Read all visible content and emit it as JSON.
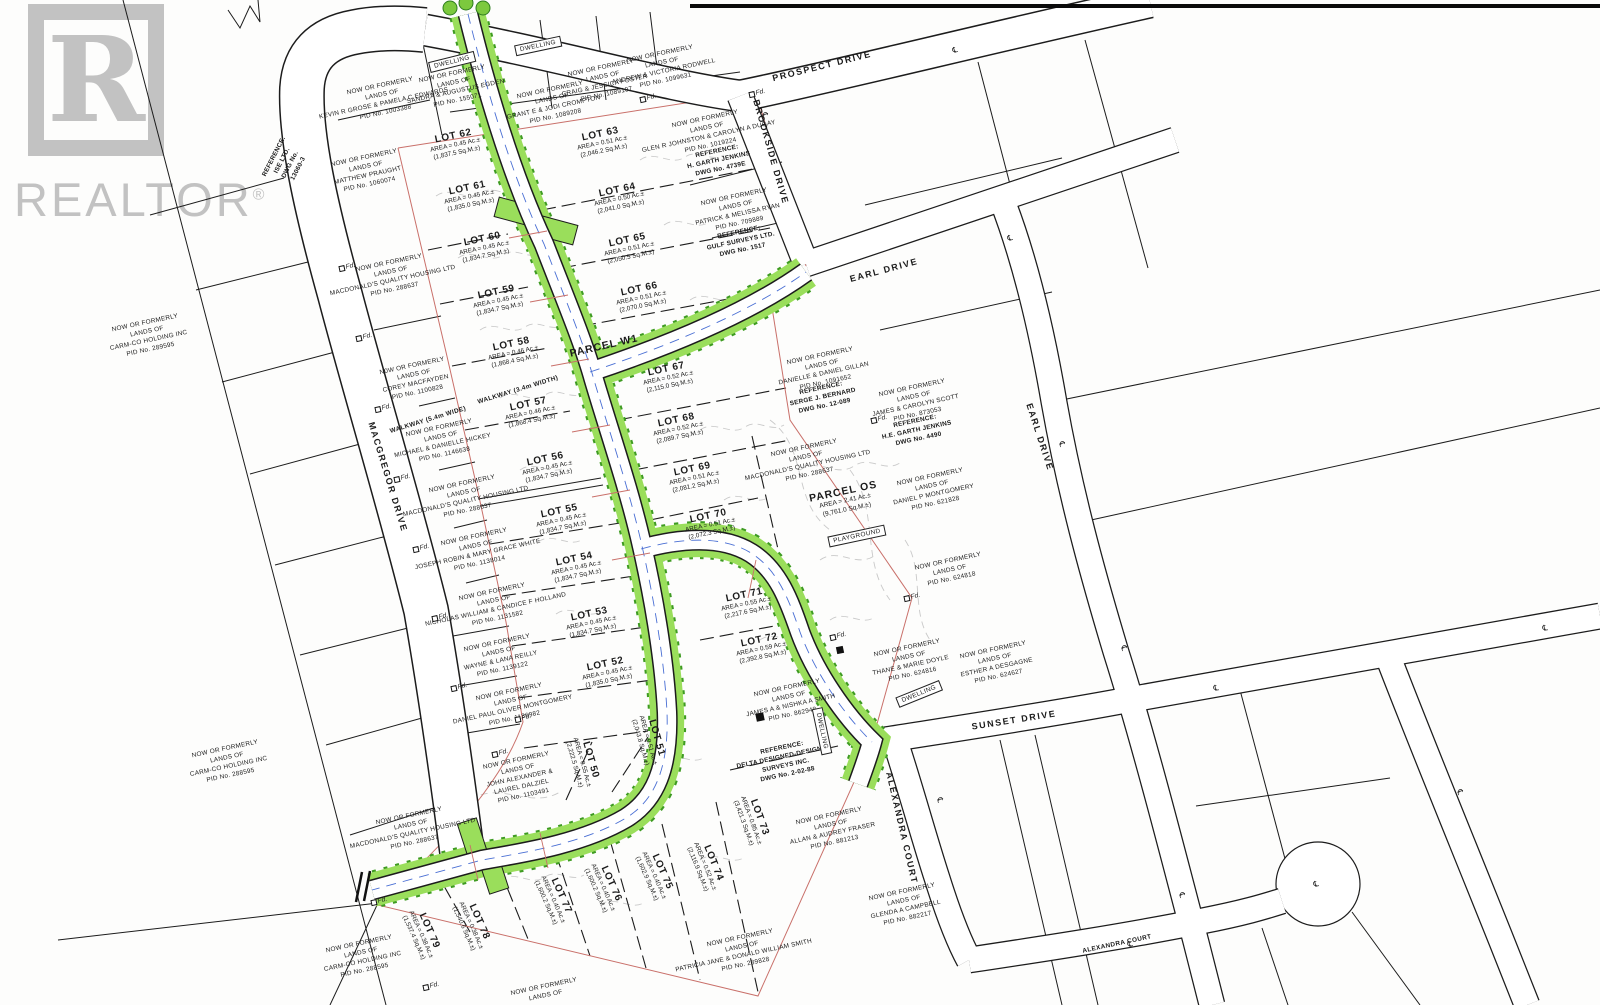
{
  "colors": {
    "watermark": "#c2c2c2",
    "line": "#1c1c1c",
    "contour": "#c9c9c9",
    "road-green": "#9ade5b",
    "green-dark": "#3e9b22",
    "boundary-red": "#c9706a",
    "centerline-blue": "#4a6fd4"
  },
  "watermark": {
    "logo_letter": "R",
    "brand": "REALTOR",
    "reg": "®"
  },
  "streets": [
    {
      "label": "PROSPECT DRIVE",
      "x": 822,
      "y": 66,
      "rot": -14
    },
    {
      "label": "BROOKSIDE DRIVE",
      "x": 771,
      "y": 152,
      "rot": 74
    },
    {
      "label": "EARL DRIVE",
      "x": 884,
      "y": 270,
      "rot": -15
    },
    {
      "label": "EARL DRIVE",
      "x": 1040,
      "y": 437,
      "rot": 72
    },
    {
      "label": "MACGREGOR DRIVE",
      "x": 388,
      "y": 477,
      "rot": 73
    },
    {
      "label": "SUNSET DRIVE",
      "x": 1014,
      "y": 720,
      "rot": -9
    },
    {
      "label": "ALEXANDRA COURT",
      "x": 902,
      "y": 828,
      "rot": 77
    },
    {
      "label": "ALEXANDRA COURT",
      "x": 1117,
      "y": 944,
      "rot": -12,
      "small": true
    },
    {
      "label": "WALKWAY (3.4m WIDTH)",
      "x": 518,
      "y": 390,
      "rot": -17,
      "small": true
    },
    {
      "label": "WALKWAY (5.4m WIDE)",
      "x": 428,
      "y": 420,
      "rot": -17,
      "small": true,
      "bold": true
    }
  ],
  "lots": [
    {
      "name": "LOT 50",
      "area": "AREA = 0.55 Ac.±",
      "sqm": "(2,222.5 Sq.M.±)",
      "x": 583,
      "y": 762,
      "rot": 74
    },
    {
      "name": "LOT 51",
      "area": "AREA = 0.51 Ac.±",
      "sqm": "(2,043.8 Sq.M.±)",
      "x": 649,
      "y": 740,
      "rot": 74
    },
    {
      "name": "LOT 52",
      "area": "AREA = 0.45 Ac.±",
      "sqm": "(1,835.0 Sq.M.±)",
      "x": 607,
      "y": 672,
      "rot": -12
    },
    {
      "name": "LOT 53",
      "area": "AREA = 0.45 Ac.±",
      "sqm": "(1,834.7 Sq.M.±)",
      "x": 591,
      "y": 622,
      "rot": -12
    },
    {
      "name": "LOT 54",
      "area": "AREA = 0.45 Ac.±",
      "sqm": "(1,834.7 Sq.M.±)",
      "x": 576,
      "y": 567,
      "rot": -12
    },
    {
      "name": "LOT 55",
      "area": "AREA = 0.45 Ac.±",
      "sqm": "(1,834.7 Sq.M.±)",
      "x": 561,
      "y": 519,
      "rot": -12
    },
    {
      "name": "LOT 56",
      "area": "AREA = 0.45 Ac.±",
      "sqm": "(1,834.7 Sq.M.±)",
      "x": 547,
      "y": 467,
      "rot": -12
    },
    {
      "name": "LOT 57",
      "area": "AREA = 0.46 Ac.±",
      "sqm": "(1,868.4 Sq.M.±)",
      "x": 530,
      "y": 412,
      "rot": -12
    },
    {
      "name": "LOT 58",
      "area": "AREA = 0.46 Ac.±",
      "sqm": "(1,868.4 Sq.M.±)",
      "x": 513,
      "y": 352,
      "rot": -12
    },
    {
      "name": "LOT 59",
      "area": "AREA = 0.45 Ac.±",
      "sqm": "(1,834.7 Sq.M.±)",
      "x": 498,
      "y": 300,
      "rot": -12
    },
    {
      "name": "LOT 60",
      "area": "AREA = 0.45 Ac.±",
      "sqm": "(1,834.7 Sq.M.±)",
      "x": 484,
      "y": 247,
      "rot": -12
    },
    {
      "name": "LOT 61",
      "area": "AREA = 0.45 Ac.±",
      "sqm": "(1,835.0 Sq.M.±)",
      "x": 469,
      "y": 196,
      "rot": -12
    },
    {
      "name": "LOT 62",
      "area": "AREA = 0.45 Ac.±",
      "sqm": "(1,837.5 Sq.M.±)",
      "x": 455,
      "y": 144,
      "rot": -12
    },
    {
      "name": "LOT 63",
      "area": "AREA = 0.51 Ac.±",
      "sqm": "(2,046.2 Sq.M.±)",
      "x": 602,
      "y": 142,
      "rot": -12
    },
    {
      "name": "LOT 64",
      "area": "AREA = 0.50 Ac.±",
      "sqm": "(2,041.0 Sq.M.±)",
      "x": 619,
      "y": 198,
      "rot": -12
    },
    {
      "name": "LOT 65",
      "area": "AREA = 0.51 Ac.±",
      "sqm": "(2,050.5 Sq.M.±)",
      "x": 629,
      "y": 248,
      "rot": -12
    },
    {
      "name": "LOT 66",
      "area": "AREA = 0.51 Ac.±",
      "sqm": "(2,070.0 Sq.M.±)",
      "x": 641,
      "y": 297,
      "rot": -12
    },
    {
      "name": "LOT 67",
      "area": "AREA = 0.52 Ac.±",
      "sqm": "(2,115.0 Sq.M.±)",
      "x": 668,
      "y": 377,
      "rot": -12
    },
    {
      "name": "LOT 68",
      "area": "AREA = 0.52 Ac.±",
      "sqm": "(2,089.7 Sq.M.±)",
      "x": 678,
      "y": 428,
      "rot": -12
    },
    {
      "name": "LOT 69",
      "area": "AREA = 0.51 Ac.±",
      "sqm": "(2,081.2 Sq.M.±)",
      "x": 694,
      "y": 477,
      "rot": -12
    },
    {
      "name": "LOT 70",
      "area": "AREA = 0.51 Ac.±",
      "sqm": "(2,072.3 Sq.M.±)",
      "x": 710,
      "y": 524,
      "rot": -12
    },
    {
      "name": "LOT 71",
      "area": "AREA = 0.55 Ac.±",
      "sqm": "(2,217.6 Sq.M.±)",
      "x": 746,
      "y": 603,
      "rot": -12
    },
    {
      "name": "LOT 72",
      "area": "AREA = 0.59 Ac.±",
      "sqm": "(2,392.8 Sq.M.±)",
      "x": 761,
      "y": 648,
      "rot": -12
    },
    {
      "name": "LOT 73",
      "area": "AREA = 0.85 Ac.±",
      "sqm": "(3,421.3 Sq.M.±)",
      "x": 752,
      "y": 820,
      "rot": 70
    },
    {
      "name": "LOT 74",
      "area": "AREA = 0.52 Ac.±",
      "sqm": "(2,116.9 Sq.M.±)",
      "x": 706,
      "y": 866,
      "rot": 68
    },
    {
      "name": "LOT 75",
      "area": "AREA = 0.40 Ac.±",
      "sqm": "(1,602.9 Sq.M.±)",
      "x": 655,
      "y": 875,
      "rot": 66
    },
    {
      "name": "LOT 76",
      "area": "AREA = 0.40 Ac.±",
      "sqm": "(1,600.2 Sq.M.±)",
      "x": 604,
      "y": 887,
      "rot": 66
    },
    {
      "name": "LOT 77",
      "area": "AREA = 0.40 Ac.±",
      "sqm": "(1,600.2 Sq.M.±)",
      "x": 554,
      "y": 899,
      "rot": 66
    },
    {
      "name": "LOT 78",
      "area": "AREA = 0.38 Ac.±",
      "sqm": "(1,540.6 Sq.M.±)",
      "x": 472,
      "y": 925,
      "rot": 66
    },
    {
      "name": "LOT 79",
      "area": "AREA = 0.38 Ac.±",
      "sqm": "(1,537.4 Sq.M.±)",
      "x": 422,
      "y": 934,
      "rot": 66
    }
  ],
  "parcels": [
    {
      "name": "PARCEL OS",
      "lines": [
        "AREA = 2.41 Ac.±",
        "(9,761.0 Sq.M.±)"
      ],
      "x": 845,
      "y": 500,
      "rot": -12
    },
    {
      "name": "PARCEL W1",
      "lines": [],
      "x": 604,
      "y": 346,
      "rot": -13
    }
  ],
  "site_labels": [
    {
      "label": "DWELLING",
      "x": 538,
      "y": 46,
      "rot": -12
    },
    {
      "label": "DWELLING",
      "x": 452,
      "y": 62,
      "rot": -14
    },
    {
      "label": "DWELLING",
      "x": 919,
      "y": 694,
      "rot": -22
    },
    {
      "label": "DWELLING",
      "x": 822,
      "y": 731,
      "rot": 78
    },
    {
      "label": "PLAYGROUND",
      "x": 857,
      "y": 536,
      "rot": -12
    }
  ],
  "owners": [
    {
      "x": 383,
      "y": 100,
      "lines": [
        "NOW OR FORMERLY",
        "LANDS OF",
        "KEVIN R GROSE & PAMELA C EDWARDS",
        "PID No. 1003388"
      ]
    },
    {
      "x": 367,
      "y": 172,
      "lines": [
        "NOW OR FORMERLY",
        "LANDS OF",
        "MATTHEW PRAUGHT",
        "PID No. 1060074"
      ]
    },
    {
      "x": 455,
      "y": 88,
      "lines": [
        "NOW OR FORMERLY",
        "LANDS OF",
        "SANDRA & AUGUSTUS EGDEN",
        "PID No. 155071"
      ]
    },
    {
      "x": 553,
      "y": 104,
      "lines": [
        "NOW OR FORMERLY",
        "LANDS OF",
        "GRANT E & JODI CROMPTON",
        "PID No. 1089208"
      ]
    },
    {
      "x": 604,
      "y": 82,
      "lines": [
        "NOW OR FORMERLY",
        "LANDS OF",
        "CRAIG & JESSICA FOSTER",
        "PID No. 1089107"
      ]
    },
    {
      "x": 663,
      "y": 68,
      "lines": [
        "NOW OR FORMERLY",
        "LANDS OF",
        "ANDREW & VICTORIA RODWELL",
        "PID No. 1099631"
      ]
    },
    {
      "x": 708,
      "y": 133,
      "lines": [
        "NOW OR FORMERLY",
        "LANDS OF",
        "GLEN R JOHNSTON & CAROLYN A DUGAY",
        "PID No. 1019224"
      ]
    },
    {
      "x": 719,
      "y": 161,
      "bold": true,
      "lines": [
        "REFERENCE:",
        "H. GARTH JENKINS",
        "DWG No. 4739E"
      ]
    },
    {
      "x": 737,
      "y": 211,
      "lines": [
        "NOW OR FORMERLY",
        "LANDS OF",
        "PATRICK & MELISSA RYAN",
        "PID No. 709889"
      ]
    },
    {
      "x": 741,
      "y": 242,
      "bold": true,
      "lines": [
        "REFERENCE:",
        "GULF SURVEYS LTD.",
        "DWG No. 1517"
      ]
    },
    {
      "x": 287,
      "y": 163,
      "rot": -63,
      "bold": true,
      "lines": [
        "REFERENCE:",
        "ISE LTD.",
        "DWG No.",
        "13060-3"
      ]
    },
    {
      "x": 148,
      "y": 337,
      "lines": [
        "NOW OR FORMERLY",
        "LANDS OF",
        "CARM-CO HOLDING INC",
        "PID No. 289595"
      ]
    },
    {
      "x": 392,
      "y": 277,
      "lines": [
        "NOW OR FORMERLY",
        "LANDS OF",
        "MACDONALD'S QUALITY HOUSING LTD",
        "PID No. 288637"
      ]
    },
    {
      "x": 415,
      "y": 380,
      "lines": [
        "N0W OR FORMERLY",
        "LANDS OF",
        "COREY MACFAYDEN",
        "PID No. 1100828"
      ]
    },
    {
      "x": 442,
      "y": 442,
      "lines": [
        "NOW OR FORMERLY",
        "LANDS OF",
        "MICHAEL & DANIELLE HICKEY",
        "PID No. 1146638"
      ]
    },
    {
      "x": 465,
      "y": 498,
      "lines": [
        "NOW OR FORMERLY",
        "LANDS OF",
        "MACDONALD'S QUALITY HOUSING LTD",
        "PID No. 288637"
      ]
    },
    {
      "x": 477,
      "y": 551,
      "lines": [
        "NOW OR FORMERLY",
        "LANDS OF",
        "JOSEPH ROBIN & MARY GRACE WHITE",
        "PID No. 1138014"
      ]
    },
    {
      "x": 495,
      "y": 606,
      "lines": [
        "NOW OR FORMERLY",
        "LANDS OF",
        "NICHOLAS WILLIAM & CANDICE F HOLLAND",
        "PID No. 1131582"
      ]
    },
    {
      "x": 500,
      "y": 657,
      "lines": [
        "NOW OR FORMERLY",
        "LANDS OF",
        "WAYNE & LANA REILLY",
        "PID No. 1139122"
      ]
    },
    {
      "x": 512,
      "y": 706,
      "lines": [
        "NOW OR FORMERLY",
        "LANDS OF",
        "DANIEL PAUL OLIVER MONTGOMERY",
        "PID No. 1136982"
      ]
    },
    {
      "x": 520,
      "y": 779,
      "lines": [
        "NOW OR FORMERLY",
        "LANDS OF",
        "JOHN ALEXANDER &",
        "LAUREL DALZIEL",
        "PID No. 1103491"
      ]
    },
    {
      "x": 228,
      "y": 763,
      "lines": [
        "NOW OR FORMERLY",
        "LANDS OF",
        "CARM-CO HOLDING INC",
        "PID No. 288595"
      ]
    },
    {
      "x": 412,
      "y": 830,
      "lines": [
        "NOW OR FORMERLY",
        "LANDS OF",
        "MACDONALD'S QUALITY HOUSING LTD",
        "PID No. 288637"
      ]
    },
    {
      "x": 823,
      "y": 370,
      "lines": [
        "NOW OR FORMERLY",
        "LANDS OF",
        "DANIELLE & DANIEL GILLAN",
        "PID No. 1091652"
      ]
    },
    {
      "x": 823,
      "y": 398,
      "bold": true,
      "lines": [
        "REFERENCE:",
        "SERGE J. BERNARD",
        "DWG No. 12-089"
      ]
    },
    {
      "x": 915,
      "y": 402,
      "lines": [
        "NOW OR FORMERLY",
        "LANDS OF",
        "JAMES & CAROLYN SCOTT",
        "PID No. 873053"
      ]
    },
    {
      "x": 917,
      "y": 431,
      "bold": true,
      "lines": [
        "REFERENCE:",
        "H.E. GARTH JENKINS",
        "DWG No. 4490"
      ]
    },
    {
      "x": 807,
      "y": 462,
      "lines": [
        "NOW OR FORMERLY",
        "LANDS OF",
        "MACDONALD'S QUALITY HOUSING LTD",
        "PID No. 288637"
      ]
    },
    {
      "x": 933,
      "y": 491,
      "lines": [
        "NOW OR FORMERLY",
        "LANDS OF",
        "DANIEL P MONTGOMERY",
        "PID No. 621828"
      ]
    },
    {
      "x": 950,
      "y": 571,
      "lines": [
        "NOW OR FORMERLY",
        "LANDS OF",
        "PID No. 624818"
      ]
    },
    {
      "x": 910,
      "y": 662,
      "lines": [
        "NOW OR FORMERLY",
        "LANDS OF",
        "THANE & MARIE DOYLE",
        "PID No. 624816"
      ]
    },
    {
      "x": 996,
      "y": 664,
      "lines": [
        "NOW OR FORMERLY",
        "LANDS OF",
        "ESTHER A DESGAGNE",
        "PID No. 624627"
      ]
    },
    {
      "x": 790,
      "y": 702,
      "lines": [
        "NOW OR FORMERLY",
        "LANDS OF",
        "JAMES A & NISHKA A SMITH",
        "PID No. 862948"
      ]
    },
    {
      "x": 785,
      "y": 762,
      "bold": true,
      "lines": [
        "REFERENCE:",
        "DELTA DESIGNED-DESIGNER",
        "SURVEYS INC.",
        "DWG No. 2-02-88"
      ]
    },
    {
      "x": 832,
      "y": 830,
      "lines": [
        "NOW OR FORMERLY",
        "LANDS OF",
        "ALLAN & AUDREY FRASER",
        "PID No. 881213"
      ]
    },
    {
      "x": 905,
      "y": 906,
      "lines": [
        "NOW OR FORMERLY",
        "LANDS OF",
        "GLENDA A CAMPBELL",
        "PID No. 882217"
      ]
    },
    {
      "x": 743,
      "y": 952,
      "lines": [
        "NOW OR FORMERLY",
        "LANDS OF",
        "PATRICIA JANE & DONALD WILLIAM SMITH",
        "PID No. 289828"
      ]
    },
    {
      "x": 362,
      "y": 958,
      "lines": [
        "NOW OR FORMERLY",
        "LANDS OF",
        "CARM-CO HOLDING INC",
        "PID No. 288595"
      ]
    },
    {
      "x": 545,
      "y": 992,
      "lines": [
        "NOW OR FORMERLY",
        "LANDS OF"
      ]
    }
  ],
  "markers": {
    "label": "Fd.",
    "positions": [
      [
        347,
        267
      ],
      [
        364,
        337
      ],
      [
        383,
        408
      ],
      [
        402,
        478
      ],
      [
        421,
        548
      ],
      [
        440,
        617
      ],
      [
        459,
        687
      ],
      [
        500,
        753
      ],
      [
        757,
        93
      ],
      [
        648,
        98
      ],
      [
        879,
        419
      ],
      [
        912,
        597
      ],
      [
        379,
        901
      ],
      [
        431,
        986
      ],
      [
        523,
        718
      ],
      [
        838,
        636
      ]
    ]
  },
  "centerlines": {
    "symbol": "℄",
    "positions": [
      [
        765,
        115,
        74
      ],
      [
        955,
        50,
        -15
      ],
      [
        1010,
        238,
        -15
      ],
      [
        1062,
        444,
        74
      ],
      [
        1124,
        648,
        74
      ],
      [
        1182,
        895,
        74
      ],
      [
        1545,
        628,
        -9
      ],
      [
        1216,
        688,
        -9
      ],
      [
        940,
        800,
        78
      ],
      [
        1130,
        944,
        -12
      ],
      [
        1316,
        884,
        -12
      ],
      [
        1460,
        792,
        72
      ]
    ]
  }
}
